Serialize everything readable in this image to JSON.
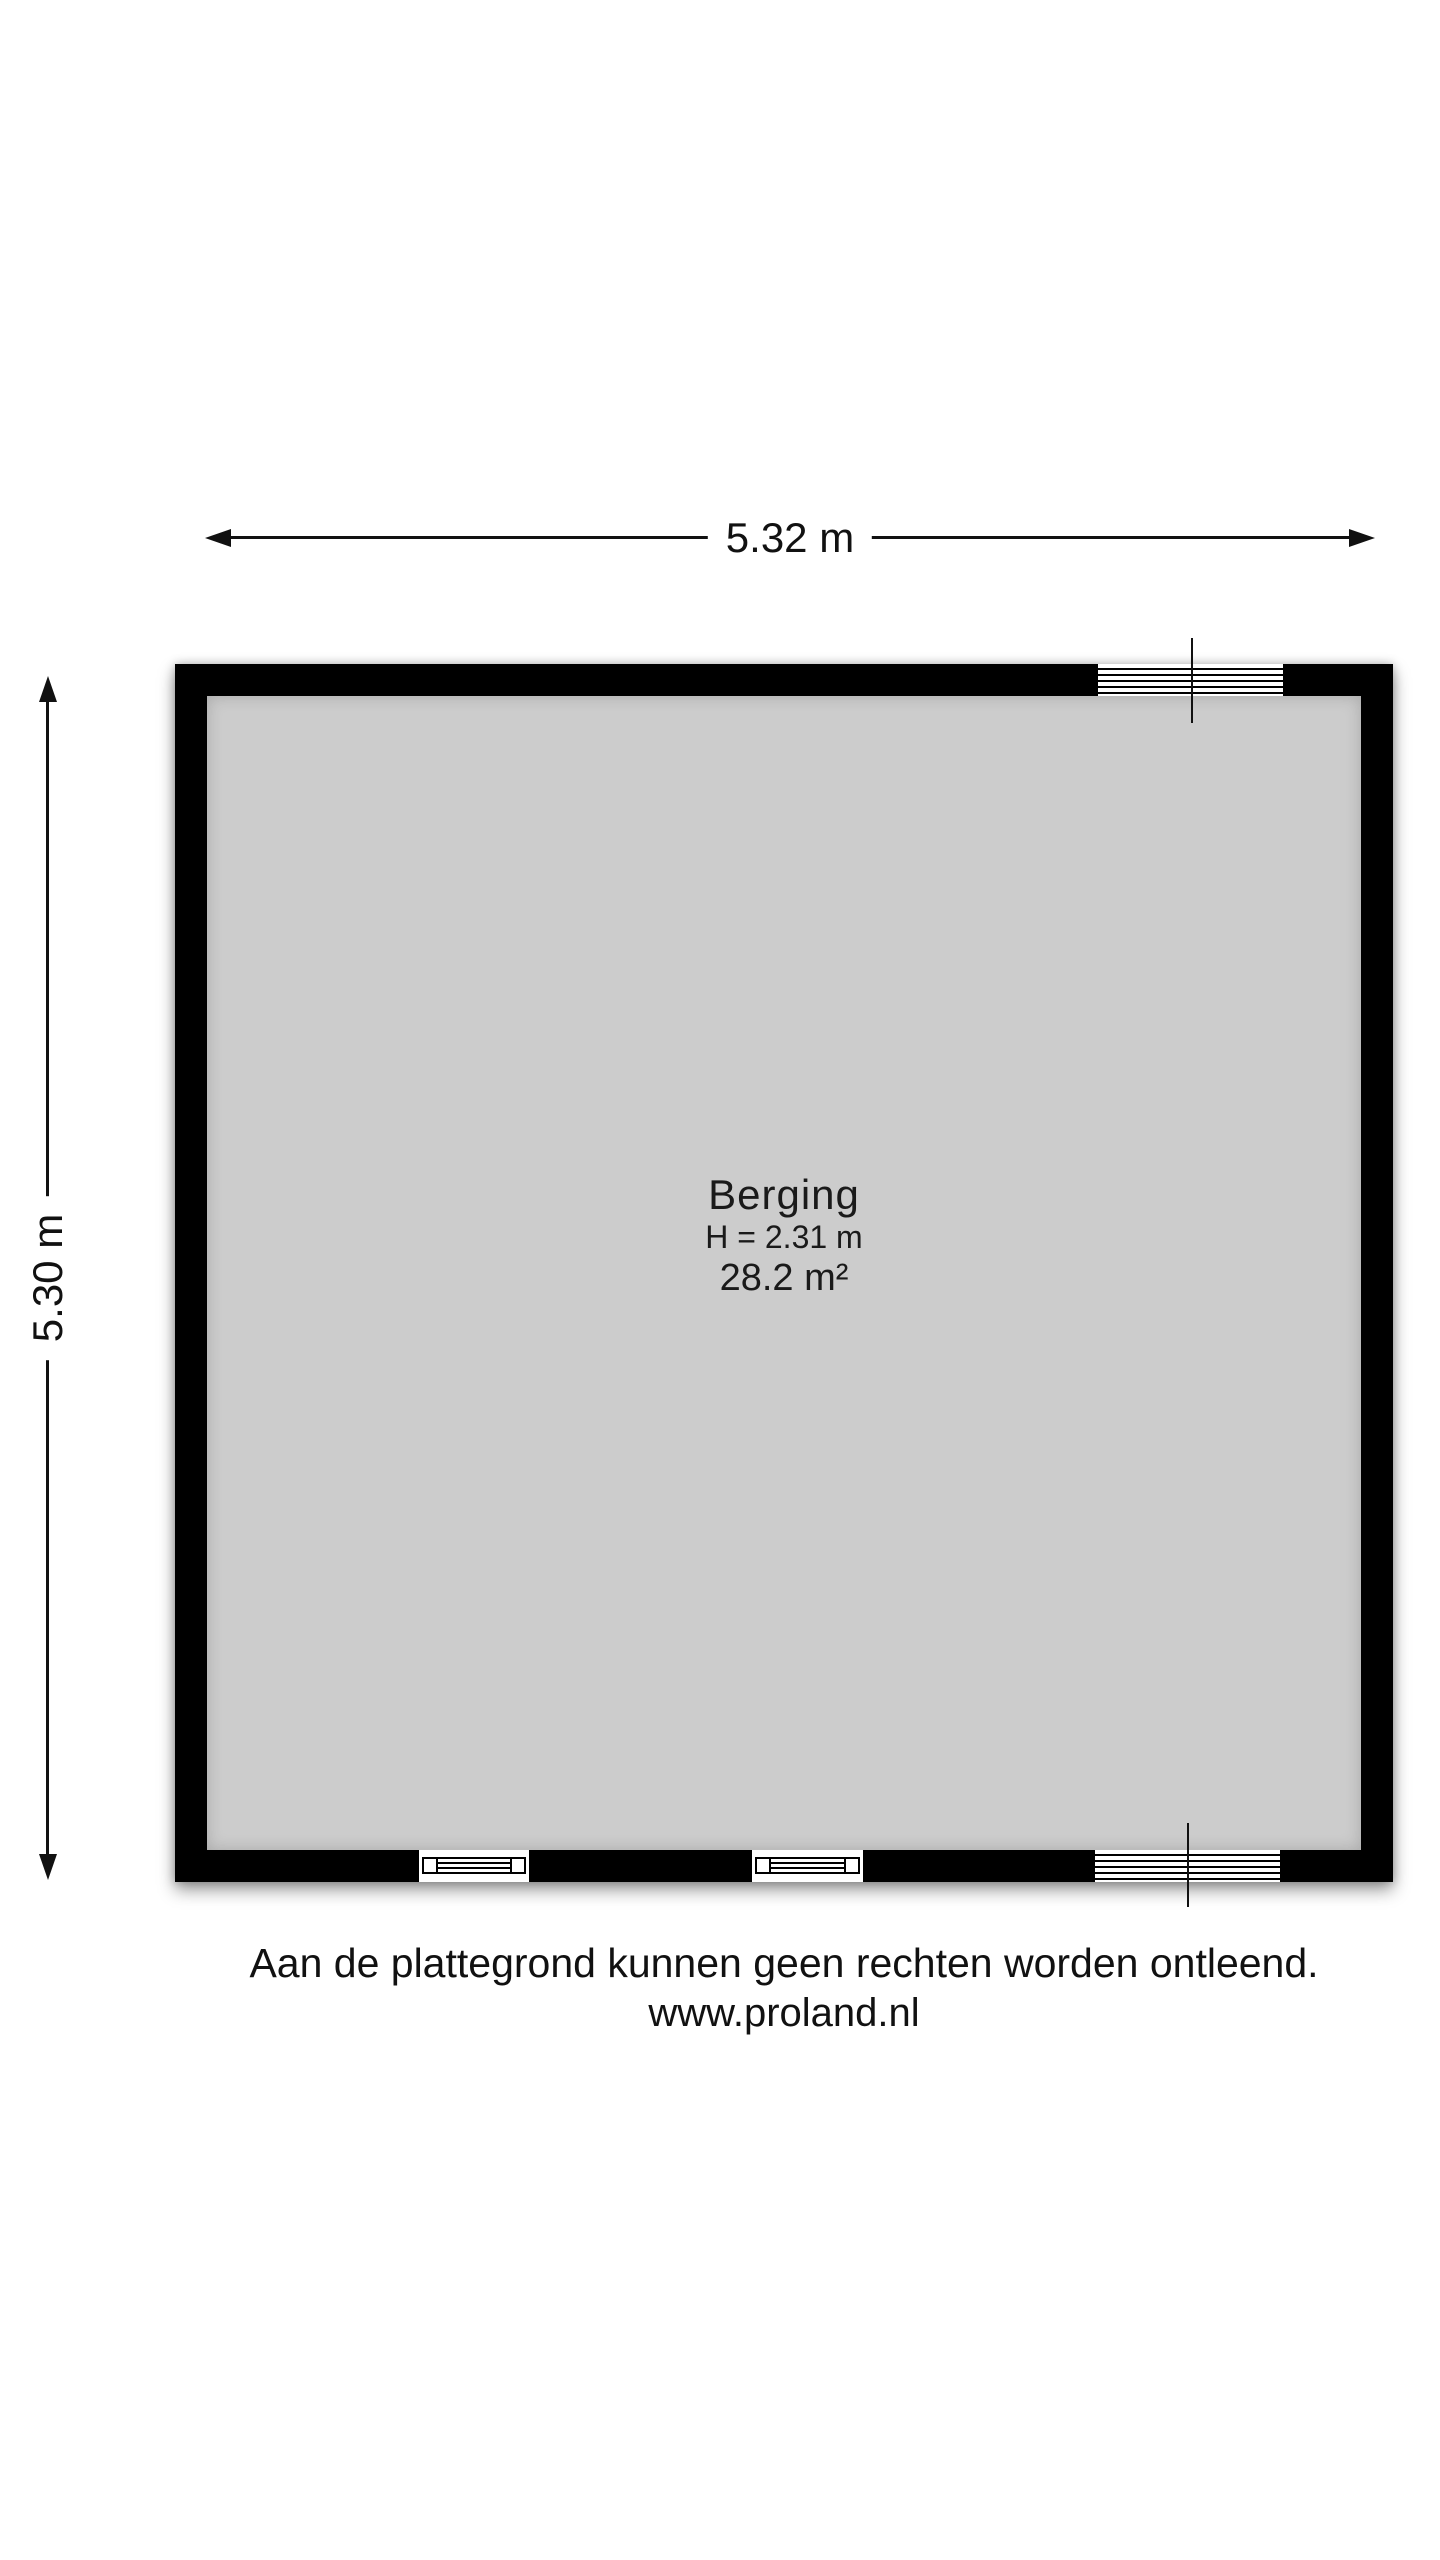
{
  "dimensions": {
    "width": {
      "label": "5.32 m"
    },
    "height": {
      "label": "5.30 m"
    }
  },
  "room": {
    "name": "Berging",
    "ceiling_height": "H = 2.31 m",
    "area": "28.2 m²"
  },
  "footer": {
    "disclaimer": "Aan de plattegrond kunnen geen rechten worden ontleend.",
    "website": "www.proland.nl"
  },
  "colors": {
    "wall": "#000000",
    "floor": "#cccccc",
    "background": "#ffffff",
    "line": "#111111"
  }
}
